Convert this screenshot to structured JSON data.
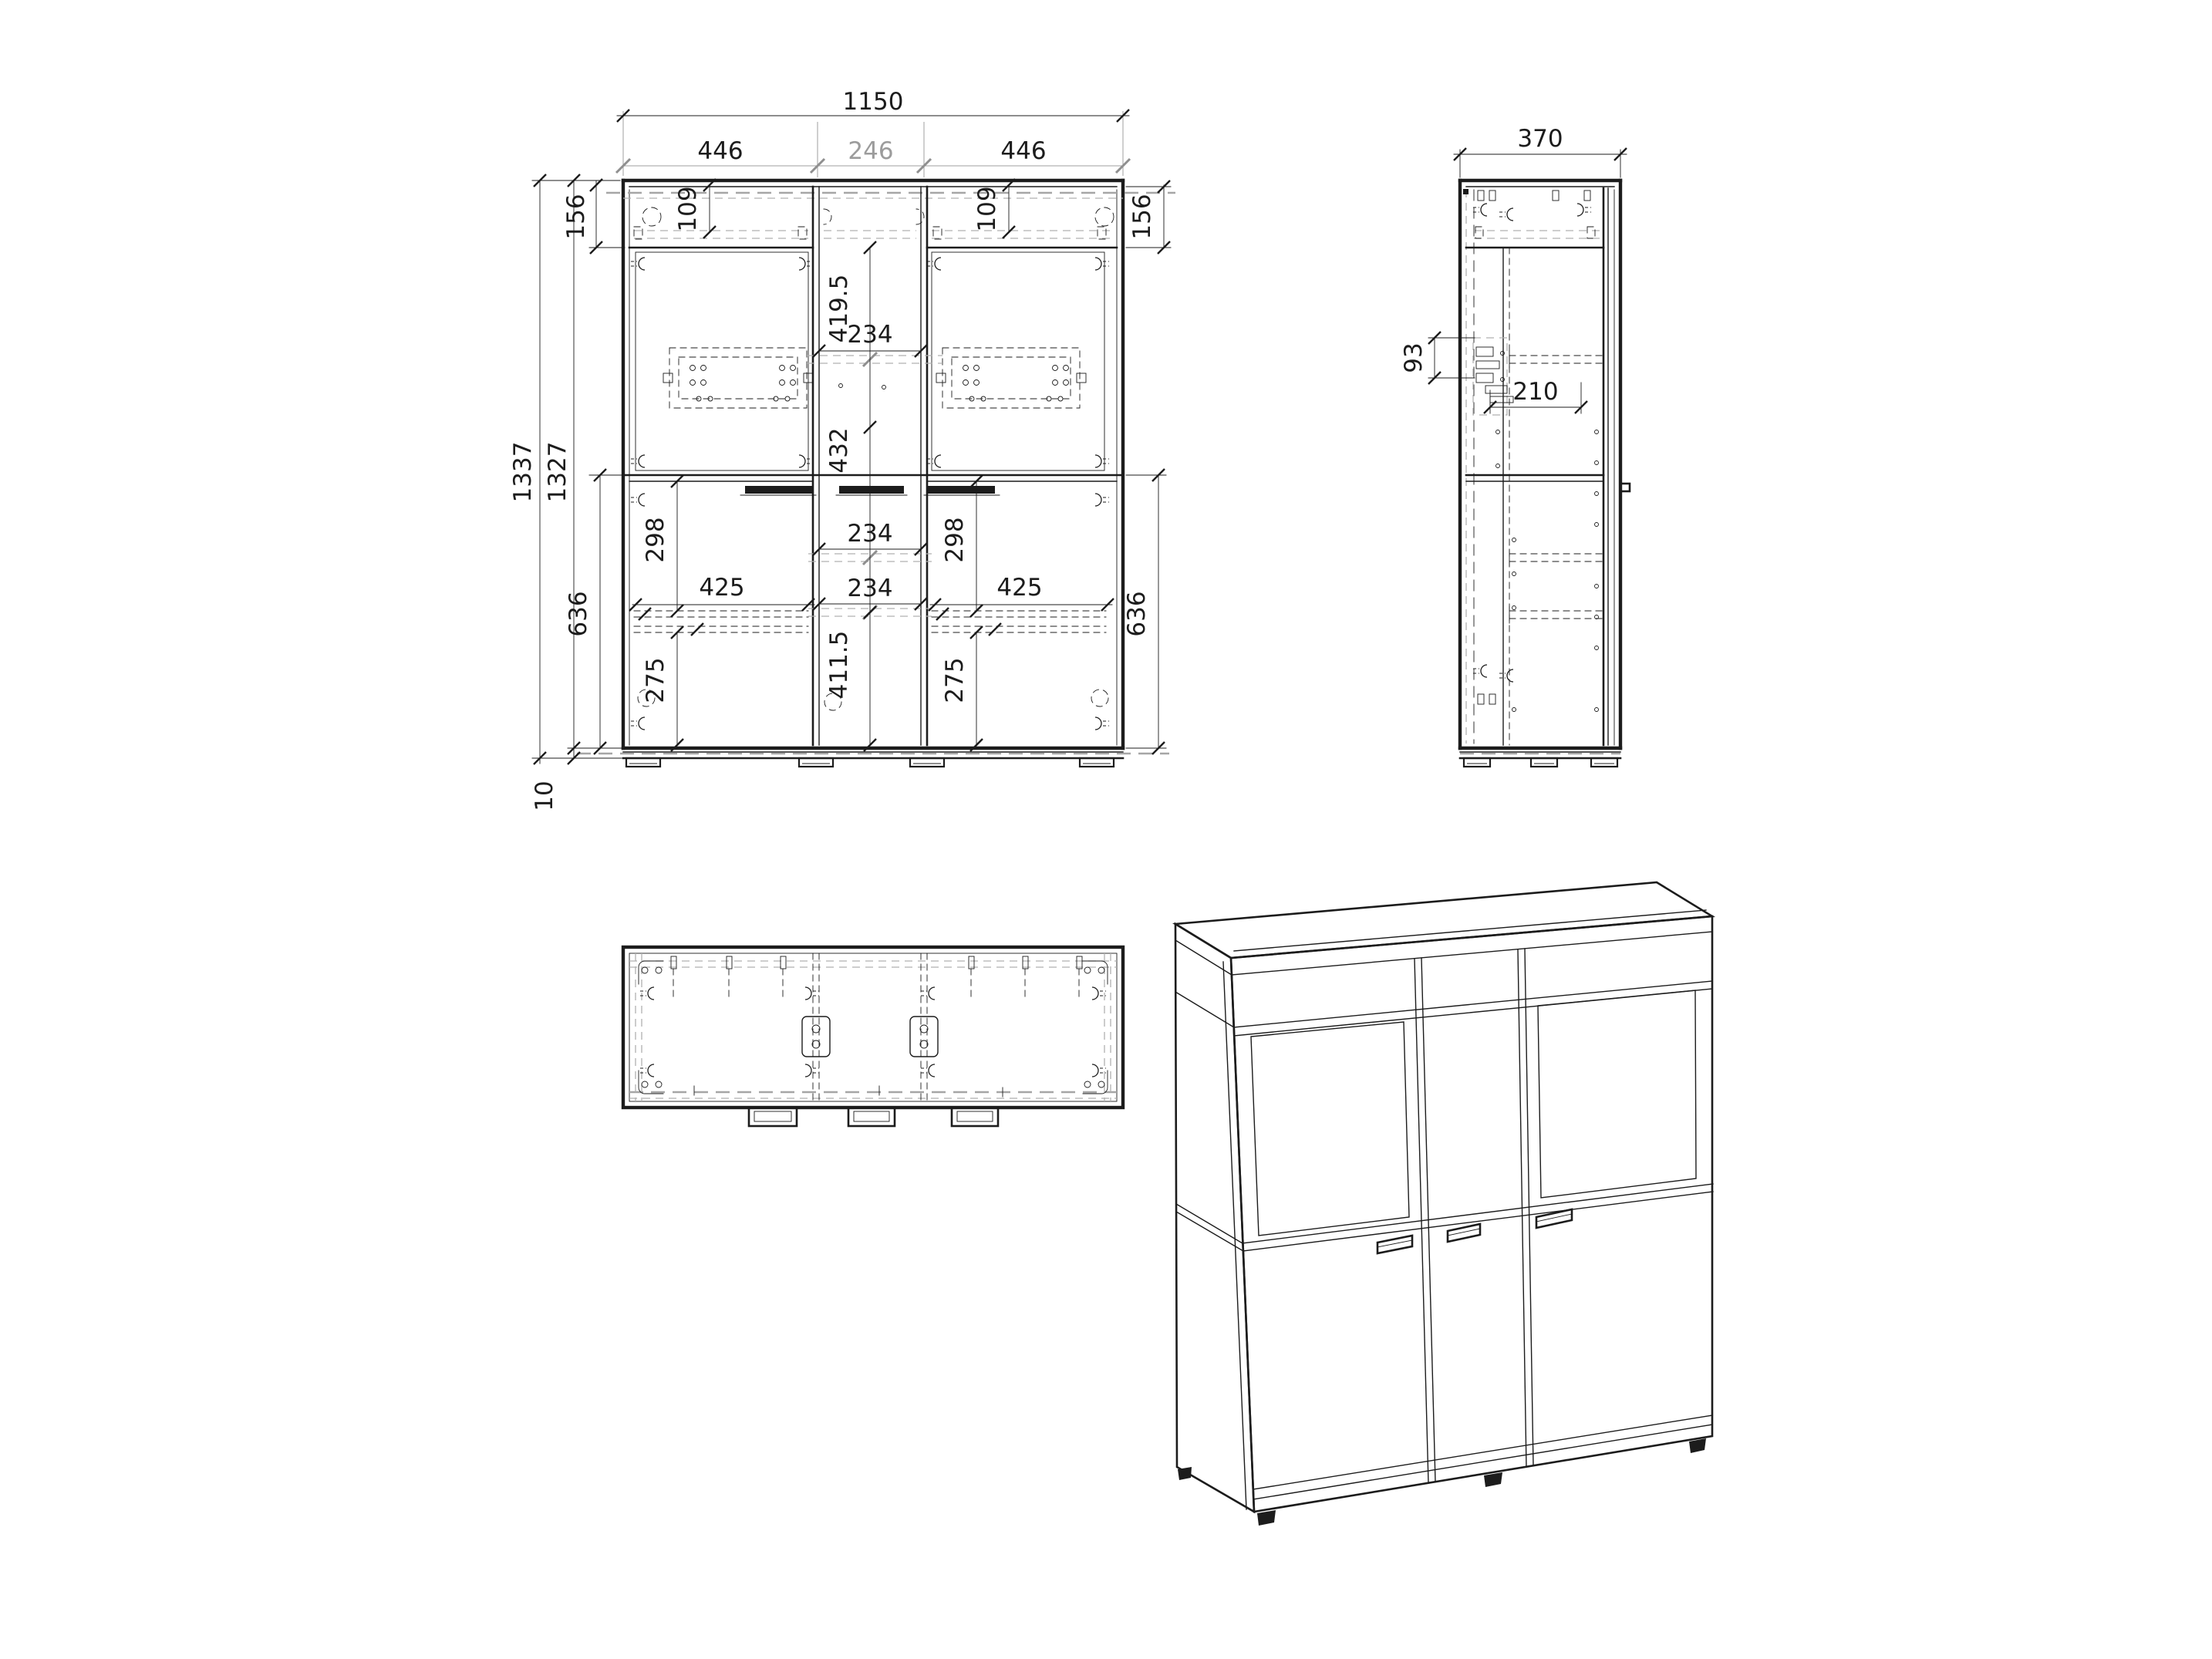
{
  "drawing": {
    "background": "#ffffff",
    "line_color": "#1c1c1c",
    "muted_color": "#9c9c9c",
    "views": {
      "front": "front-elevation",
      "side": "side-elevation",
      "bottom": "bottom-plan",
      "iso": "isometric-projection"
    }
  },
  "front_view": {
    "top_dims": {
      "total": "1150",
      "left_door": "446",
      "center": "246",
      "right_door": "446"
    },
    "left_dims": {
      "overall_height": "1337",
      "carcass_height": "1327",
      "top_rail": "156",
      "base_section": "636",
      "plinth": "10"
    },
    "right_dims": {
      "top_rail": "156",
      "base_section": "636"
    },
    "center_dims": {
      "upper_door": "419.5",
      "width_a": "234",
      "mid_section": "432",
      "width_b": "234",
      "width_c": "234",
      "lower_door": "411.5"
    },
    "left_door": {
      "top_offset": "109",
      "shelf_top": "298",
      "shelf_width": "425",
      "shelf_bottom": "275"
    },
    "right_door": {
      "top_offset": "109",
      "shelf_top": "298",
      "shelf_width": "425",
      "shelf_bottom": "275"
    }
  },
  "side_view": {
    "dims": {
      "depth": "370",
      "hanger_height": "93",
      "hanger_depth": "210"
    }
  }
}
